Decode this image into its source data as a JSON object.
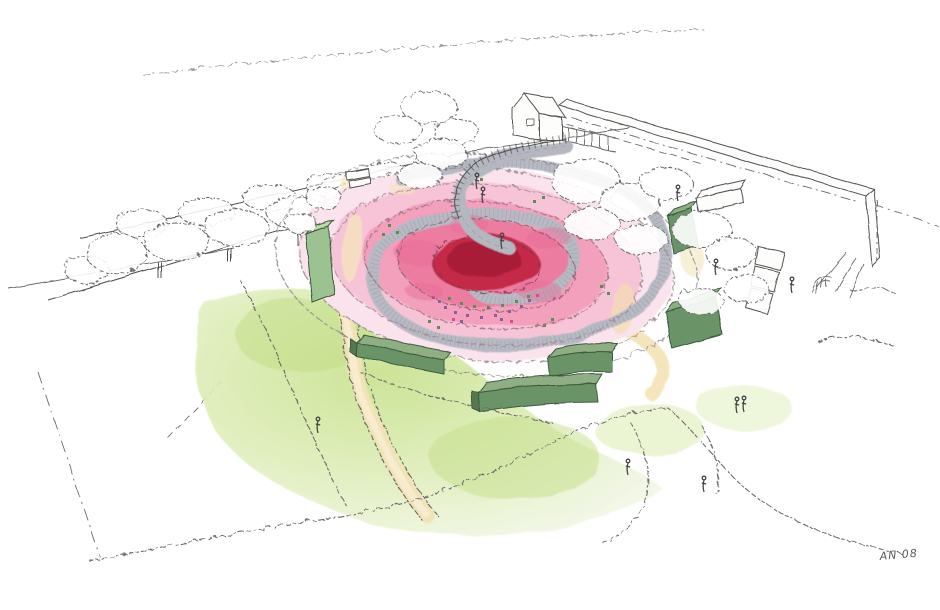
{
  "scene": {
    "signature": "AN 08",
    "palette": {
      "paper": "#FFFFFF",
      "ink": "#4A4A4A",
      "rose_center_dark": "#A81D37",
      "rose_center_red": "#C42A47",
      "rose_deep_pink": "#EC7BA0",
      "rose_mid_pink": "#F2A0BC",
      "rose_light_pink": "#F7C4D7",
      "rose_pale_pink": "#FBE3ED",
      "accent_purple": "#8E5C96",
      "accent_magenta": "#D84E8C",
      "walkway_gray": "#B7BAC3",
      "sand_path": "#F3E3B6",
      "lawn_green": "#CDE595",
      "lawn_pale": "#E9F3D3",
      "hedge_front": "#6B9468",
      "hedge_top": "#8FAE83",
      "hedge_light": "#9CC291",
      "speckle_green": "#5F8C55"
    }
  }
}
